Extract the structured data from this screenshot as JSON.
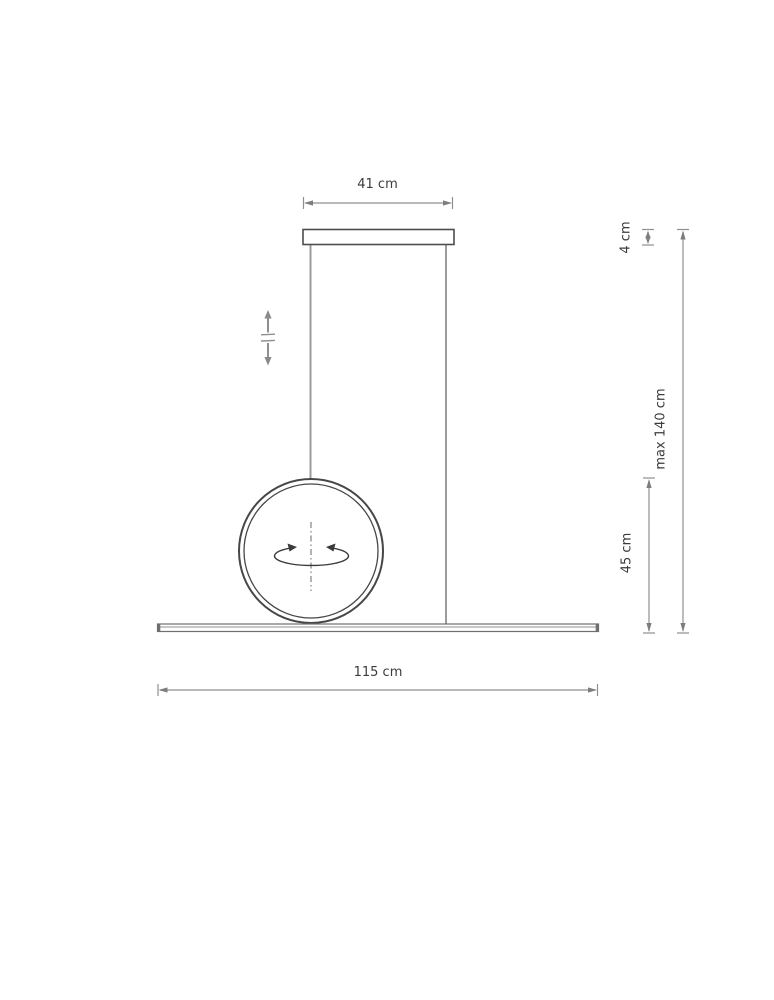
{
  "diagram": {
    "kind": "pendant-lamp-dimension-drawing",
    "labels": {
      "canopy_width": "41 cm",
      "canopy_height": "4 cm",
      "max_height": "max 140 cm",
      "ring_size": "45 cm",
      "bar_length": "115 cm"
    },
    "dimensions_cm": {
      "canopy_width": 41,
      "canopy_height": 4,
      "max_height": 140,
      "ring_size": 45,
      "bar_length": 115
    },
    "icons": {
      "height_adjust": "height-adjust-arrows-icon",
      "rotation": "rotation-around-axis-icon"
    },
    "colors": {
      "background": "#ffffff",
      "dimension_line": "#8f8f8f",
      "arrowhead": "#7d7d7d",
      "text": "#3c3c3c",
      "fixture_outline": "#4d4d4d",
      "wire": "#9b9b9b",
      "rotation_symbol": "#3a3a3a"
    }
  }
}
